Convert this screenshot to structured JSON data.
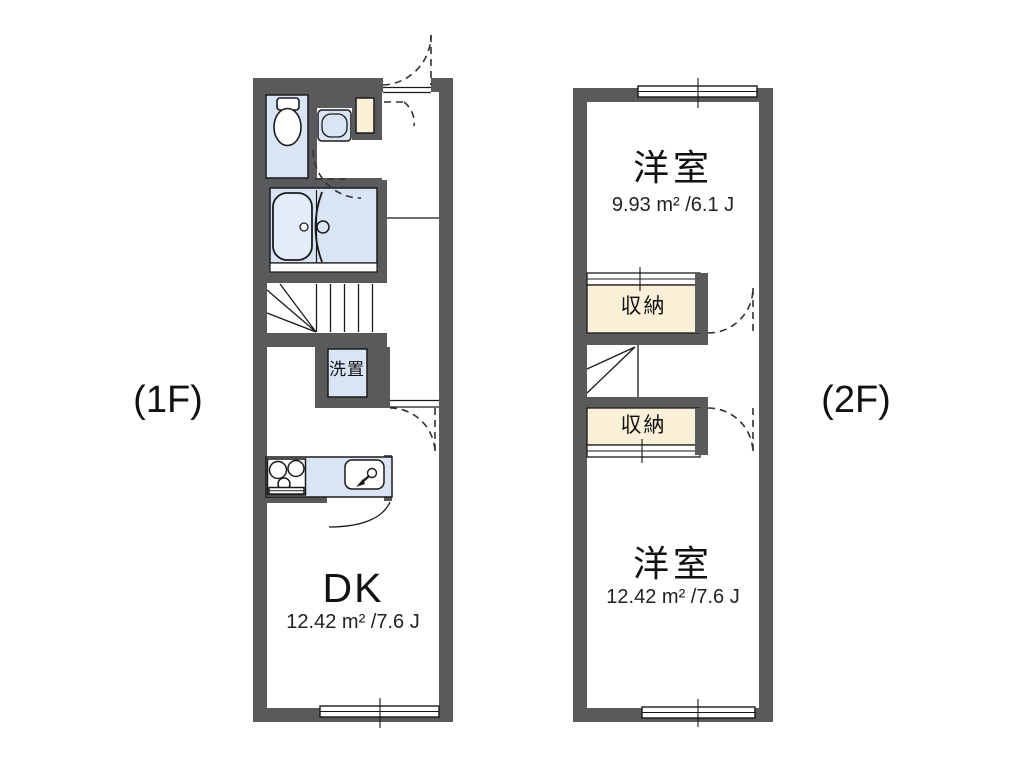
{
  "floor1": {
    "floor_label": "(1F)",
    "dining_kitchen": {
      "name": "DK",
      "area": "12.42 m² /7.6 J"
    },
    "laundry_label": "洗置"
  },
  "floor2": {
    "floor_label": "(2F)",
    "upper_room": {
      "name": "洋室",
      "area": "9.93 m² /6.1 J"
    },
    "lower_room": {
      "name": "洋室",
      "area": "12.42 m² /7.6 J"
    },
    "upper_storage_label": "収納",
    "lower_storage_label": "収納"
  },
  "colors": {
    "wall": "#595a5c",
    "fixture_blue": "#d9e4f4",
    "storage_cream": "#faf0d8",
    "line": "#1a1a1a",
    "dash": "#333333",
    "background": "#ffffff"
  }
}
